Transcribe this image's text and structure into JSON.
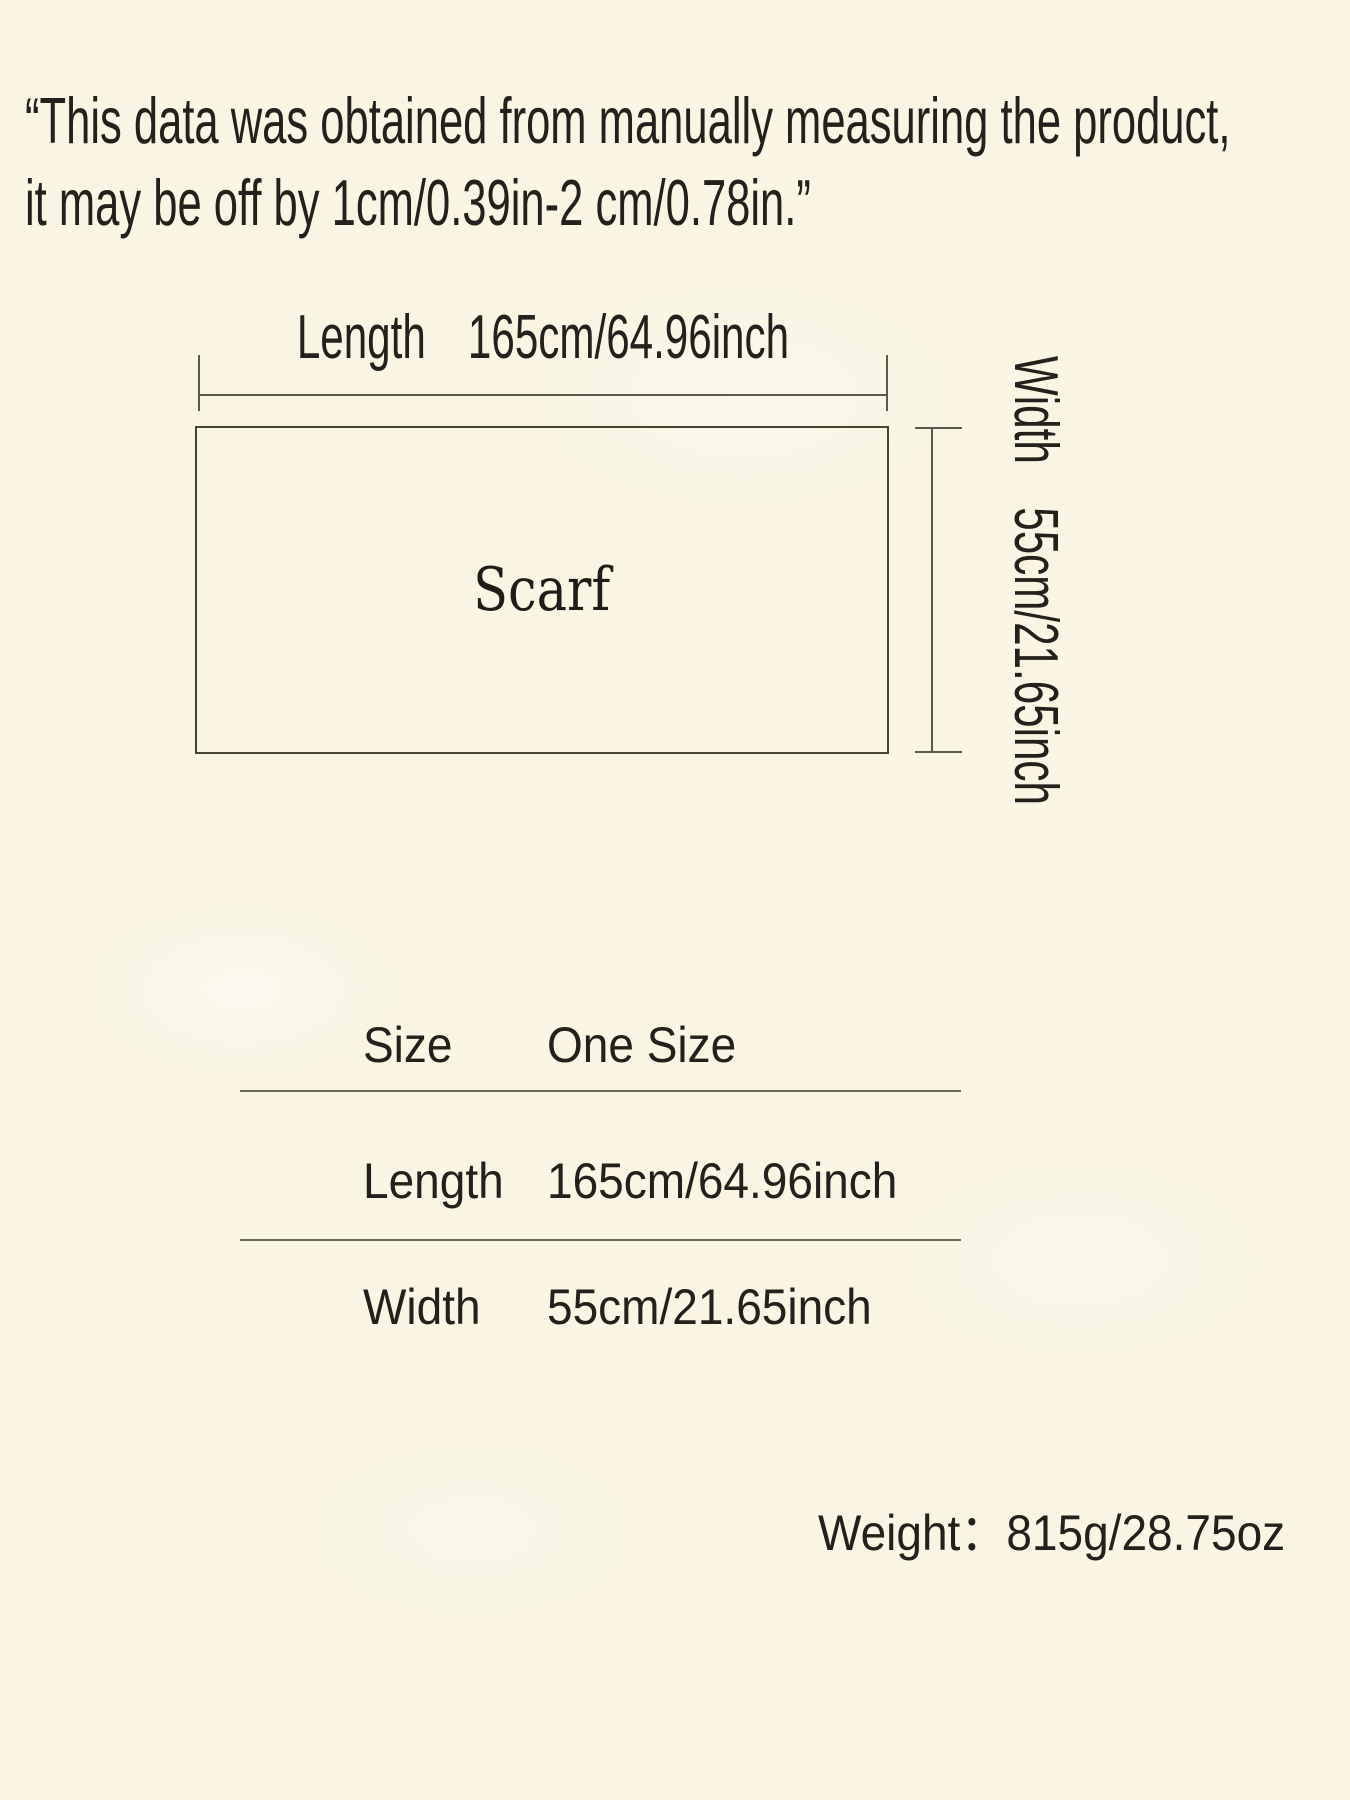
{
  "page": {
    "background_color": "#f9f5e2",
    "text_color": "#22211b",
    "line_color": "#5a594b"
  },
  "disclaimer": {
    "line1": "“This data was obtained from manually measuring the product,",
    "line2": "it may be off by 1cm/0.39in-2 cm/0.78in.”"
  },
  "diagram": {
    "product_label": "Scarf",
    "length": {
      "label": "Length",
      "value": "165cm/64.96inch"
    },
    "width": {
      "label": "Width",
      "value": "55cm/21.65inch"
    }
  },
  "size_table": {
    "rows": [
      {
        "label": "Size",
        "value": "One Size"
      },
      {
        "label": "Length",
        "value": "165cm/64.96inch"
      },
      {
        "label": "Width",
        "value": "55cm/21.65inch"
      }
    ]
  },
  "weight": {
    "label": "Weight：",
    "value": "815g/28.75oz"
  }
}
